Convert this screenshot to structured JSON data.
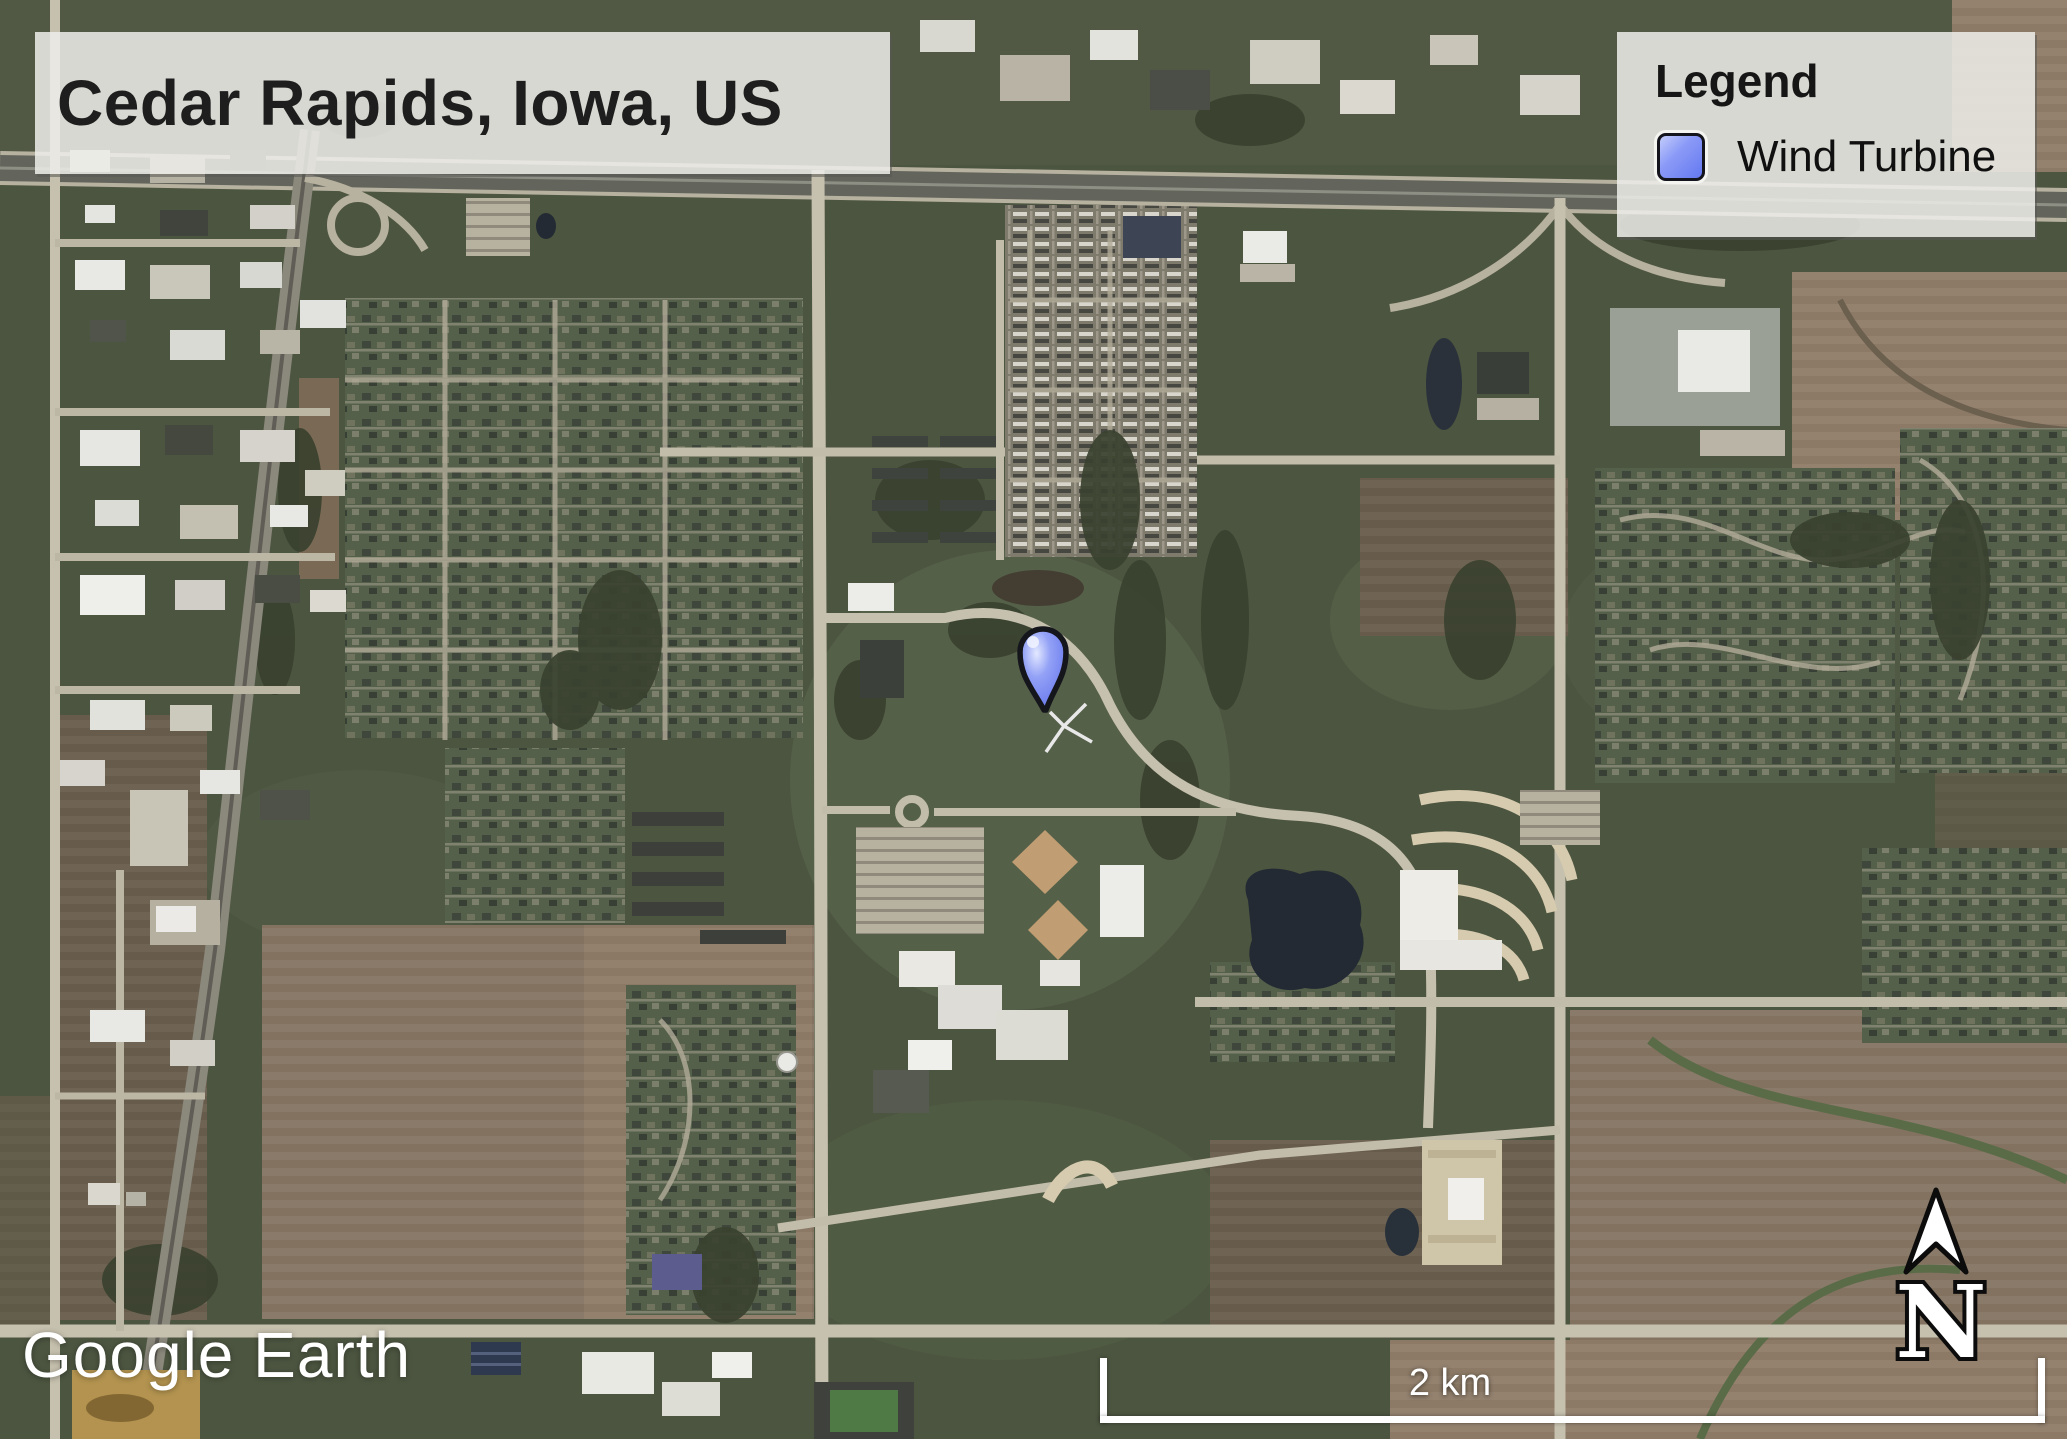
{
  "map_view": {
    "type": "satellite-imagery",
    "title": "Cedar Rapids, Iowa, US",
    "watermark": "Google Earth",
    "scale_bar_label": "2 km",
    "north_label": "N"
  },
  "legend": {
    "title": "Legend",
    "items": [
      {
        "label": "Wind Turbine",
        "symbol": "blue-rounded-square",
        "color": "#6f80f0"
      }
    ]
  },
  "marker": {
    "type": "placemark-pin",
    "represents": "Wind Turbine",
    "fill_color": "#7e8df2",
    "outline_color": "#15151c"
  },
  "palette": {
    "panel_background": "rgba(238,237,233,0.86)",
    "panel_text": "#1e1e1e",
    "overlay_text": "#ffffff",
    "terrain_green": "#4c5540",
    "field_brown": "#8a7a69"
  }
}
